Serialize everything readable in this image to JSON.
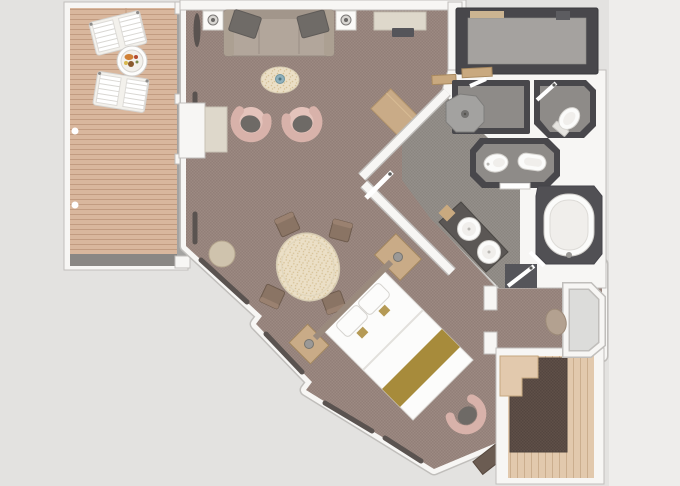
{
  "meta": {
    "type": "floor-plan",
    "view": "top-down"
  },
  "rooms": [
    "veranda",
    "living-room",
    "dining-area",
    "bedroom",
    "bathroom",
    "walk-in-closet",
    "shower-room",
    "wc",
    "toilet-bidet-room",
    "second-veranda"
  ],
  "colors": {
    "background": "#e3e2e0",
    "background_right_strip": "#eeedeb",
    "wall_fill": "#f7f6f4",
    "wall_outline": "#c0bebb",
    "window_band": "#a4a3a1",
    "carpet_main": "#9c8a82",
    "carpet_main_check": "#927f78",
    "carpet_dark": "#5f5048",
    "carpet_dark_check": "#544640",
    "deck_wood": "#d9b79d",
    "deck_plank_line": "#c29c81",
    "deck_wood_light": "#e2c9ad",
    "deck_plank_line_2": "#cbae8e",
    "deck_band_dark": "#8a8784",
    "dark_wall": "#48474b",
    "closet_floor": "#a5a29f",
    "bath_floor": "#94908b",
    "bath_floor_check": "#8b8680",
    "room_floor_gray": "#8e8b88",
    "shower_tray": "#a3a2a0",
    "tub_surround": "#515054",
    "fixture_white": "#fbfbfa",
    "fixture_inner": "#f0eeeb",
    "vanity_counter": "#5b5755",
    "sofa": "#b2a69b",
    "sofa_back": "#a2968b",
    "sofa_cushion": "#6f6b67",
    "armchair": "#d8b2aa",
    "armchair_fill": "#e4c3bb",
    "armchair_cushion": "#6e6a66",
    "dining_table": "#ebdfc6",
    "dining_speckle": "#d6c196",
    "chair_brown": "#8a7464",
    "chair_brown_back": "#9a8170",
    "bed_white": "#fcfcfb",
    "bed_runner_gold": "#a78b3b",
    "gold_pillow": "#b59a55",
    "headboard": "#9a8a7d",
    "wood_furniture": "#c9ab87",
    "cabinet_beige": "#ded8cb",
    "tv_dark": "#55555a",
    "curtain_dark": "#5a5350",
    "ottoman": "#b3a190",
    "ottoman_small": "#cfc3ad",
    "door_tan": "#c9a97f",
    "glass_gray": "#dcdcda",
    "plate_base": "#f3f1ec",
    "dish_blue": "#8fb0bc",
    "lamp_gray": "#9b9997",
    "bench_dark": "#6b5c52"
  }
}
